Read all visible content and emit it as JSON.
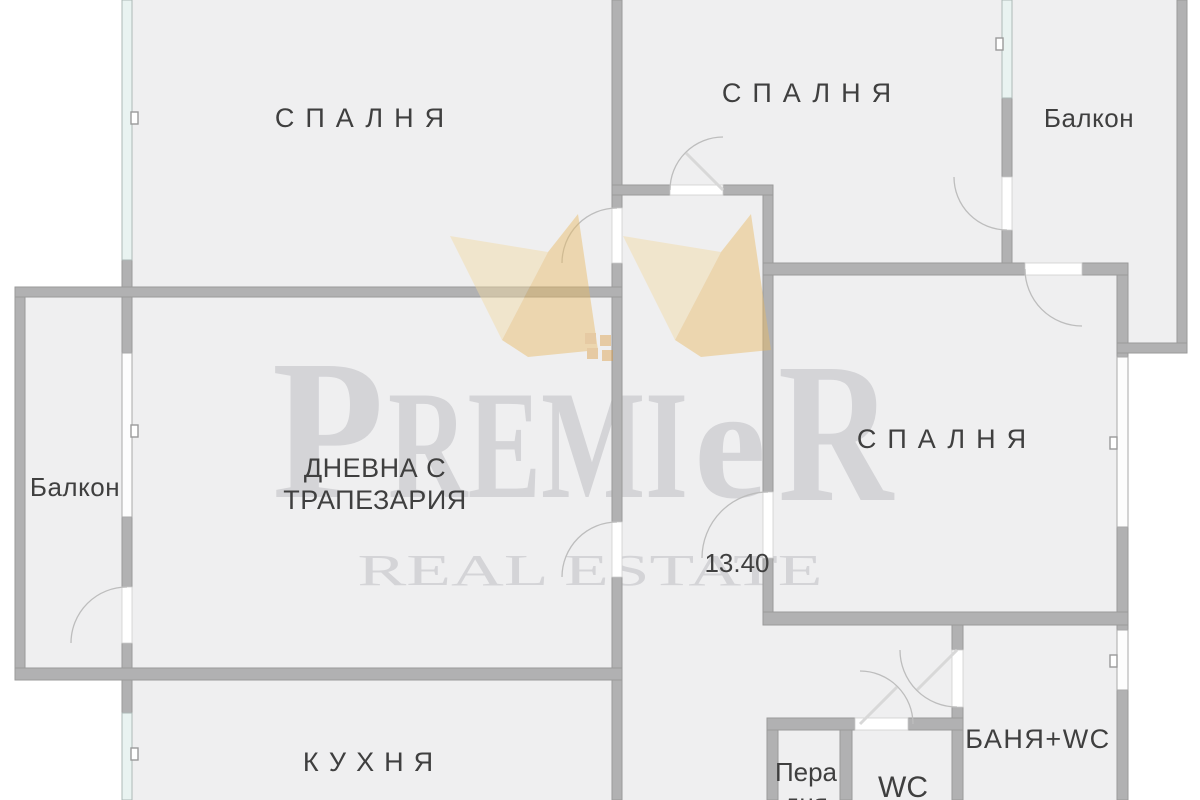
{
  "rooms": {
    "bedroom_top_left": {
      "label": "СПАЛНЯ"
    },
    "bedroom_top_middle": {
      "label": "СПАЛНЯ"
    },
    "bedroom_right": {
      "label": "СПАЛНЯ"
    },
    "balcony_top_right": {
      "label": "Балкон"
    },
    "balcony_left": {
      "label": "Балкон"
    },
    "living_dining": {
      "label_line1": "ДНЕВНА С",
      "label_line2": "ТРАПЕЗАРИЯ"
    },
    "kitchen": {
      "label": "КУХНЯ"
    },
    "hallway": {
      "area_label": "13.40"
    },
    "laundry": {
      "label_line1": "Пера",
      "label_line2": "дня"
    },
    "wc": {
      "label": "WC"
    },
    "bath_wc": {
      "label": "БАНЯ+WC"
    }
  },
  "watermark": {
    "brand": "PREMIER",
    "brand_parts": {
      "p": "P",
      "remi": "REMI",
      "e": "e",
      "r": "R"
    },
    "tagline": "REAL ESTATE"
  },
  "colors": {
    "background": "#ffffff",
    "floor": "#efeff0",
    "wall": "#b1b1b2",
    "wall_edge": "#9a9a9a",
    "window_glass": "#e9f3f1",
    "window_glass_edge": "#adb8b6",
    "window_white": "#fdfdfd",
    "window_white_edge": "#a9a9a9",
    "door_gap": "#ffffff",
    "door_gap_edge": "#cfcfcf",
    "arc": "#bdbdbd",
    "leaf": "#d8d8d8",
    "label_text": "#3f3f3f",
    "watermark_text": "#d4d4d7",
    "logo_gold_light": "#f2d9a2",
    "logo_gold": "#e9ba62",
    "logo_orange": "#dc9e48"
  }
}
